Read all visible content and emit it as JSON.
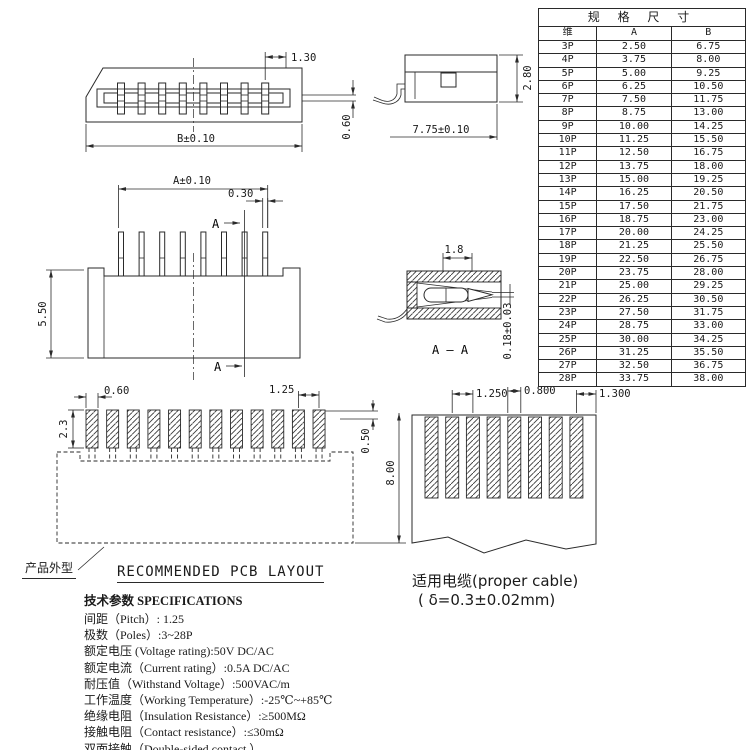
{
  "table": {
    "title": "规 格 尺 寸",
    "col_pin": "维",
    "col_a": "A",
    "col_b": "B",
    "rows": [
      [
        "3P",
        "2.50",
        "6.75"
      ],
      [
        "4P",
        "3.75",
        "8.00"
      ],
      [
        "5P",
        "5.00",
        "9.25"
      ],
      [
        "6P",
        "6.25",
        "10.50"
      ],
      [
        "7P",
        "7.50",
        "11.75"
      ],
      [
        "8P",
        "8.75",
        "13.00"
      ],
      [
        "9P",
        "10.00",
        "14.25"
      ],
      [
        "10P",
        "11.25",
        "15.50"
      ],
      [
        "11P",
        "12.50",
        "16.75"
      ],
      [
        "12P",
        "13.75",
        "18.00"
      ],
      [
        "13P",
        "15.00",
        "19.25"
      ],
      [
        "14P",
        "16.25",
        "20.50"
      ],
      [
        "15P",
        "17.50",
        "21.75"
      ],
      [
        "16P",
        "18.75",
        "23.00"
      ],
      [
        "17P",
        "20.00",
        "24.25"
      ],
      [
        "18P",
        "21.25",
        "25.50"
      ],
      [
        "19P",
        "22.50",
        "26.75"
      ],
      [
        "20P",
        "23.75",
        "28.00"
      ],
      [
        "21P",
        "25.00",
        "29.25"
      ],
      [
        "22P",
        "26.25",
        "30.50"
      ],
      [
        "23P",
        "27.50",
        "31.75"
      ],
      [
        "24P",
        "28.75",
        "33.00"
      ],
      [
        "25P",
        "30.00",
        "34.25"
      ],
      [
        "26P",
        "31.25",
        "35.50"
      ],
      [
        "27P",
        "32.50",
        "36.75"
      ],
      [
        "28P",
        "33.75",
        "38.00"
      ]
    ]
  },
  "top_view": {
    "dim_pitch": "1.30",
    "dim_width": "B±0.10",
    "dim_slot": "0.60"
  },
  "side_view": {
    "dim_depth": "7.75±0.10",
    "dim_height": "2.80"
  },
  "front_view": {
    "dim_span": "A±0.10",
    "dim_pin_width": "0.30",
    "dim_height": "5.50",
    "section_label_top": "A",
    "section_label_bottom": "A"
  },
  "section_view": {
    "dim_contact_width": "1.8",
    "dim_contact_gap": "0.18±0.03",
    "label": "A — A"
  },
  "pcb_layout": {
    "dim_pad_width": "0.60",
    "dim_pitch": "1.25",
    "dim_pad_height": "2.3",
    "dim_offset": "0.50",
    "dim_depth": "8.00",
    "title": "RECOMMENDED PCB LAYOUT",
    "outline_label": "产品外型"
  },
  "cable": {
    "dim_pitch": "1.250",
    "dim_conductor_width": "0.800",
    "dim_margin": "1.300",
    "caption": "适用电缆(proper cable)",
    "caption_detail": "( δ=0.3±0.02mm)"
  },
  "specifications": {
    "heading": "技术参数 SPECIFICATIONS",
    "items": [
      "间距（Pitch）: 1.25",
      "极数（Poles）:3~28P",
      "额定电压 (Voltage rating):50V DC/AC",
      "额定电流（Current rating）:0.5A DC/AC",
      "耐压值（Withstand Voltage）:500VAC/m",
      "工作温度（Working Temperature）:-25℃~+85℃",
      "绝缘电阻（Insulation Resistance）:≥500MΩ",
      "接触电阻（Contact resistance）:≤30mΩ",
      "双面接触（Double-sided contact ）"
    ]
  }
}
